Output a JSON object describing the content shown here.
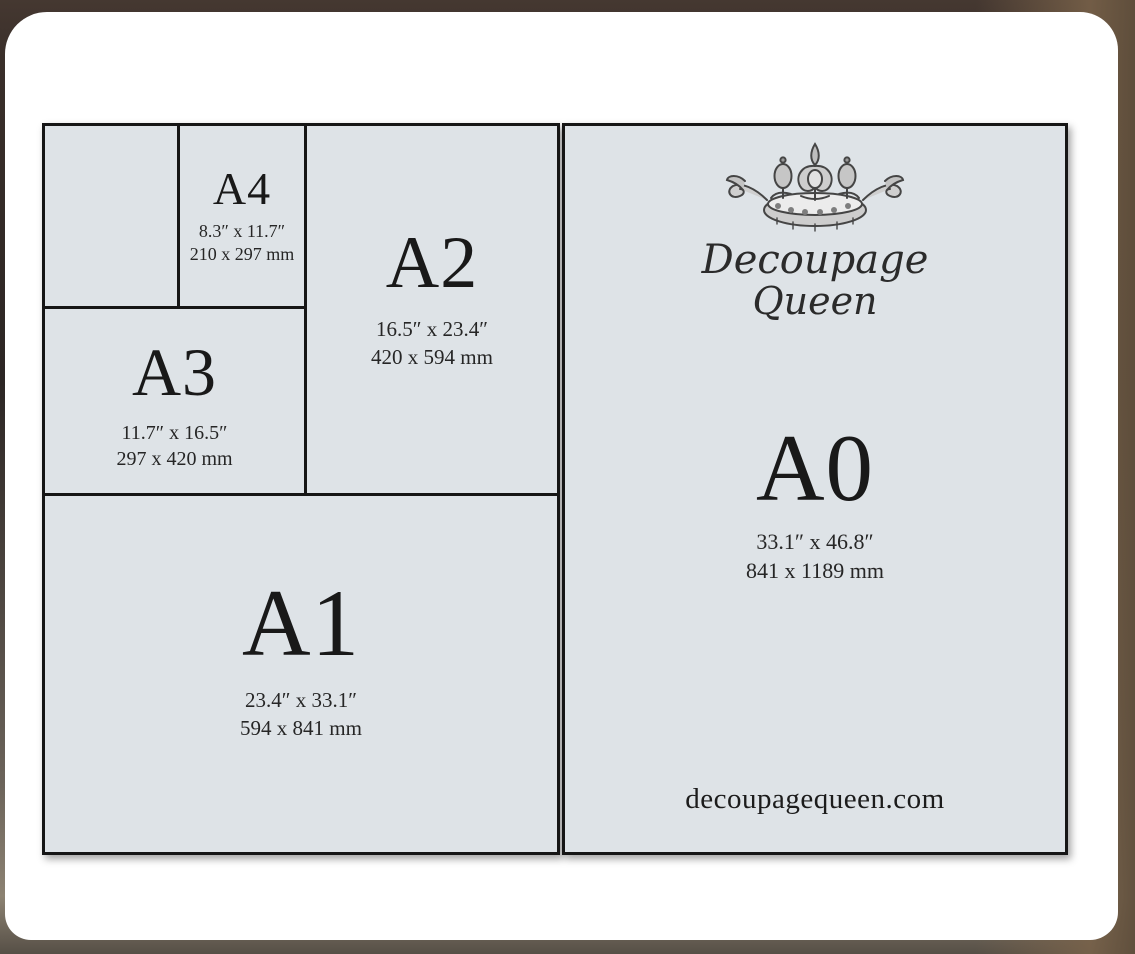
{
  "brand": {
    "name_line1": "Decoupage",
    "name_line2": "Queen",
    "website": "decoupagequeen.com"
  },
  "panels": {
    "a4": {
      "label": "A4",
      "inches": "8.3″ x 11.7″",
      "mm": "210 x 297 mm"
    },
    "a3": {
      "label": "A3",
      "inches": "11.7″ x 16.5″",
      "mm": "297 x 420 mm"
    },
    "a2": {
      "label": "A2",
      "inches": "16.5″ x 23.4″",
      "mm": "420 x 594 mm"
    },
    "a1": {
      "label": "A1",
      "inches": "23.4″ x 33.1″",
      "mm": "594 x 841 mm"
    },
    "a0": {
      "label": "A0",
      "inches": "33.1″ x 46.8″",
      "mm": "841 x 1189 mm"
    }
  },
  "icons": {
    "crown": "crown-icon"
  },
  "colors": {
    "panel_fill": "#dee3e7",
    "line": "#161616",
    "text": "#1d1d1d",
    "card": "#ffffff",
    "background_dark": "#2c2624",
    "background_brown": "#8c8272"
  }
}
